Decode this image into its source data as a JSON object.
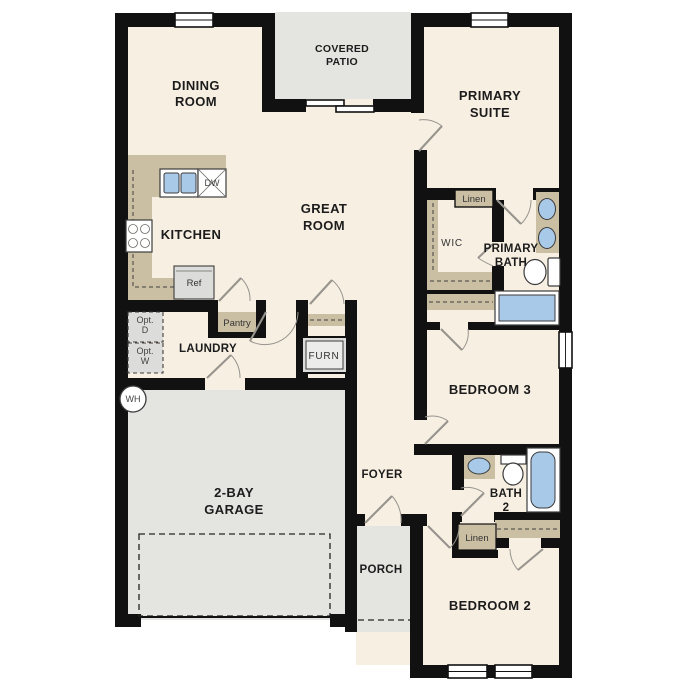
{
  "colors": {
    "wall": "#111111",
    "floor": "#f7efe2",
    "outdoor": "#e4e4e1",
    "cabinet": "#cbbfa3",
    "water": "#a9c9e9",
    "fixline": "#3c3c3c",
    "doorline": "#97948e",
    "textdark": "#1c1c1c",
    "appliance": "#dcdcda"
  },
  "labels": {
    "dining_room": {
      "l1": "DINING",
      "l2": "ROOM"
    },
    "covered_patio": {
      "l1": "COVERED",
      "l2": "PATIO"
    },
    "primary_suite": {
      "l1": "PRIMARY",
      "l2": "SUITE"
    },
    "great_room": {
      "l1": "GREAT",
      "l2": "ROOM"
    },
    "kitchen": "KITCHEN",
    "wic": "WIC",
    "primary_bath": {
      "l1": "PRIMARY",
      "l2": "BATH"
    },
    "laundry": "LAUNDRY",
    "pantry": "Pantry",
    "furnace": "FURN",
    "linen_upper": "Linen",
    "linen_lower": "Linen",
    "bedroom3": "BEDROOM 3",
    "foyer": "FOYER",
    "bath2": {
      "l1": "BATH",
      "l2": "2"
    },
    "porch": "PORCH",
    "bedroom2": "BEDROOM 2",
    "garage": {
      "l1": "2-BAY",
      "l2": "GARAGE"
    },
    "refrigerator": "Ref",
    "dishwasher": "DW",
    "water_heater": "WH",
    "opt_dryer": {
      "l1": "Opt.",
      "l2": "D"
    },
    "opt_washer": {
      "l1": "Opt.",
      "l2": "W"
    }
  }
}
